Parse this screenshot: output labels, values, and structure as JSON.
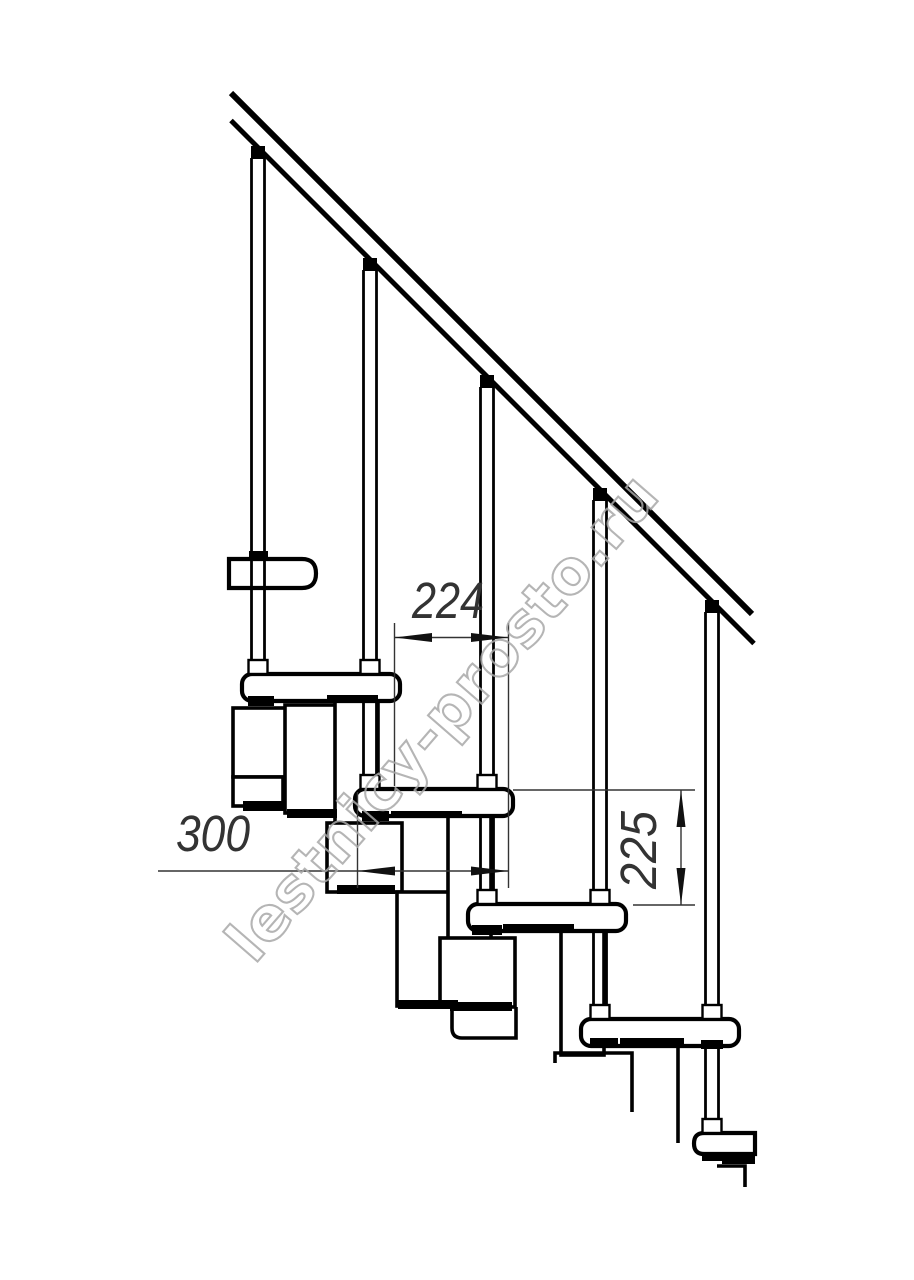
{
  "drawing": {
    "type": "staircase-side-view-technical-drawing",
    "subject": "modular staircase with handrail, balusters, treads and central spine modules",
    "watermark": "lestnicy-prosto.ru",
    "colors": {
      "line": "#000000",
      "dimension": "#333333",
      "watermark": "#a9a9a9",
      "background": "#ffffff"
    },
    "dimensions": [
      {
        "id": "step-run",
        "value": "224",
        "orientation": "horizontal"
      },
      {
        "id": "tread-length",
        "value": "300",
        "orientation": "horizontal"
      },
      {
        "id": "step-rise",
        "value": "225",
        "orientation": "vertical"
      }
    ],
    "elements": {
      "steps": 5,
      "balusters": 5,
      "handrail": true
    }
  }
}
